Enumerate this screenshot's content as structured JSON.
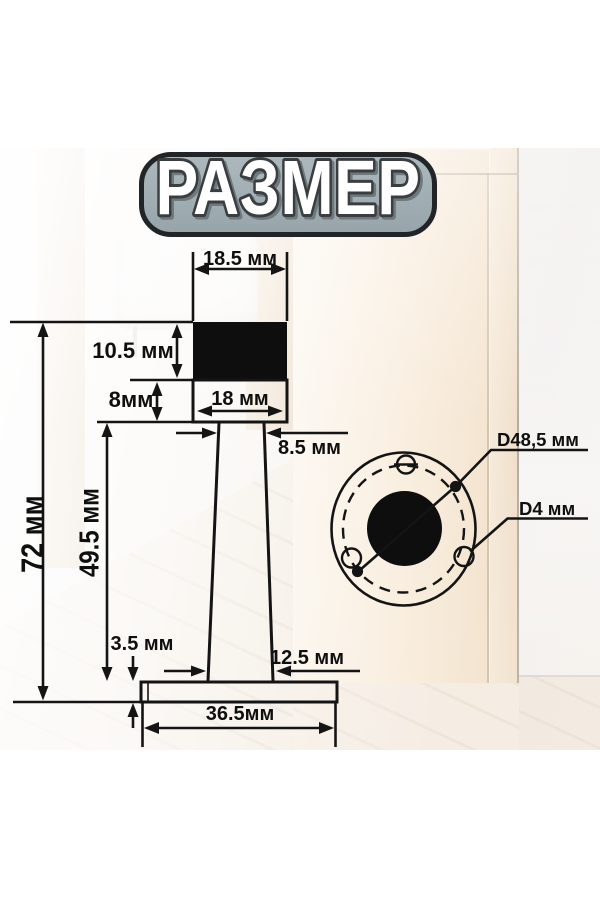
{
  "title": {
    "label": "РАЗМЕР"
  },
  "side_view": {
    "dim_top_width": "18.5 мм",
    "dim_cap_height": "10.5 мм",
    "dim_body_height": "8мм",
    "dim_body_width": "18 мм",
    "dim_stem_top_width": "8.5 мм",
    "dim_total_height": "72 мм",
    "dim_stem_height": "49.5 мм",
    "dim_base_thickness": "3.5 мм",
    "dim_stem_bottom_width": "12.5 мм",
    "dim_base_width": "36.5мм"
  },
  "top_view": {
    "dim_outer_diameter": "D48,5 мм",
    "dim_hole_diameter": "D4 мм"
  },
  "colors": {
    "line": "#141414",
    "badge_fill": "#9fabb1",
    "badge_border": "#222527",
    "title_fill": "#ffffff",
    "title_stroke": "#3a3e40"
  }
}
